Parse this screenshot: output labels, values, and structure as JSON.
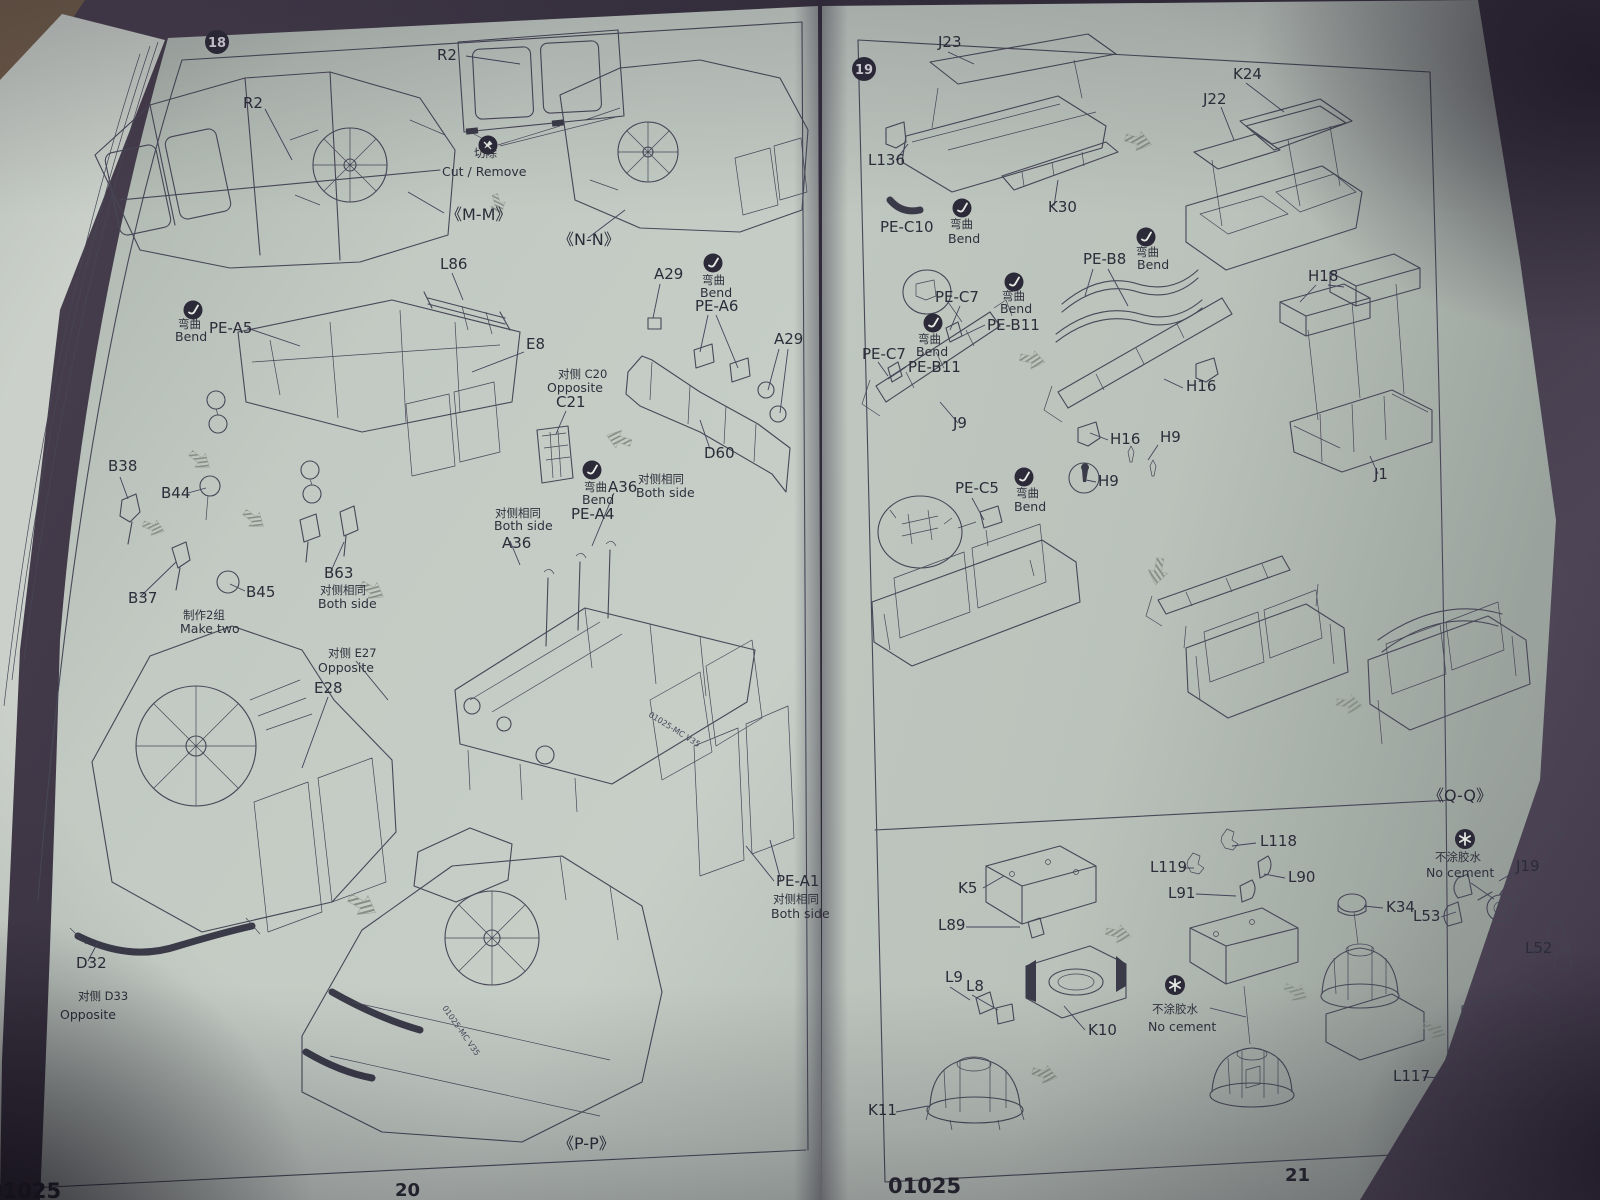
{
  "kit_number": "01025",
  "colors": {
    "paper": "#bcc4bd",
    "ink": "#474757",
    "background": "#3a3342",
    "badge": "#2c2a38"
  },
  "icons": {
    "bend": "dark-circle-with-white-bent-wire",
    "cut_remove": "dark-circle-with-white-blade",
    "no_cement": "dark-circle-with-white-asterisk",
    "step_badge": "dark-filled-circle-white-number"
  },
  "left_page": {
    "step": "18",
    "page_number": "20",
    "kit_code": "01025",
    "labels": [
      {
        "text": "R2"
      },
      {
        "text": "R2"
      },
      {
        "text": "切除"
      },
      {
        "text": "Cut / Remove"
      },
      {
        "text": "《M-M》"
      },
      {
        "text": "《N-N》"
      },
      {
        "text": "L86"
      },
      {
        "text": "弯曲"
      },
      {
        "text": "Bend"
      },
      {
        "text": "PE-A5"
      },
      {
        "text": "E8"
      },
      {
        "text": "对侧 C20"
      },
      {
        "text": "Opposite"
      },
      {
        "text": "C21"
      },
      {
        "text": "A29"
      },
      {
        "text": "弯曲"
      },
      {
        "text": "Bend"
      },
      {
        "text": "PE-A6"
      },
      {
        "text": "A29"
      },
      {
        "text": "D60"
      },
      {
        "text": "B38"
      },
      {
        "text": "B44"
      },
      {
        "text": "B37"
      },
      {
        "text": "B45"
      },
      {
        "text": "制作2组"
      },
      {
        "text": "Make two"
      },
      {
        "text": "B63"
      },
      {
        "text": "对侧相同"
      },
      {
        "text": "Both side"
      },
      {
        "text": "弯曲"
      },
      {
        "text": "Bend"
      },
      {
        "text": "PE-A4"
      },
      {
        "text": "A36"
      },
      {
        "text": "对侧相同"
      },
      {
        "text": "Both side"
      },
      {
        "text": "对侧相同"
      },
      {
        "text": "Both side"
      },
      {
        "text": "A36"
      },
      {
        "text": "对侧 E27"
      },
      {
        "text": "Opposite"
      },
      {
        "text": "E28"
      },
      {
        "text": "D32"
      },
      {
        "text": "对侧 D33"
      },
      {
        "text": "Opposite"
      },
      {
        "text": "PE-A1"
      },
      {
        "text": "对侧相同"
      },
      {
        "text": "Both side"
      },
      {
        "text": "《P-P》"
      },
      {
        "text": "20"
      },
      {
        "text": "01025"
      },
      {
        "text": "01025-MC V35"
      },
      {
        "text": "01025-MC V35"
      }
    ]
  },
  "right_page": {
    "step": "19",
    "page_number": "21",
    "kit_code": "01025",
    "labels": [
      {
        "text": "J23"
      },
      {
        "text": "L136"
      },
      {
        "text": "PE-C10"
      },
      {
        "text": "弯曲"
      },
      {
        "text": "Bend"
      },
      {
        "text": "K30"
      },
      {
        "text": "K24"
      },
      {
        "text": "J22"
      },
      {
        "text": "PE-C7"
      },
      {
        "text": "弯曲"
      },
      {
        "text": "Bend"
      },
      {
        "text": "PE-B11"
      },
      {
        "text": "PE-C7"
      },
      {
        "text": "弯曲"
      },
      {
        "text": "Bend"
      },
      {
        "text": "PE-B11"
      },
      {
        "text": "J9"
      },
      {
        "text": "PE-B8"
      },
      {
        "text": "弯曲"
      },
      {
        "text": "Bend"
      },
      {
        "text": "H16"
      },
      {
        "text": "H16"
      },
      {
        "text": "H9"
      },
      {
        "text": "H9"
      },
      {
        "text": "PE-C5"
      },
      {
        "text": "弯曲"
      },
      {
        "text": "Bend"
      },
      {
        "text": "H18"
      },
      {
        "text": "J1"
      },
      {
        "text": "《Q-Q》"
      },
      {
        "text": "K5"
      },
      {
        "text": "L89"
      },
      {
        "text": "L9"
      },
      {
        "text": "L8"
      },
      {
        "text": "K10"
      },
      {
        "text": "K11"
      },
      {
        "text": "L119"
      },
      {
        "text": "L118"
      },
      {
        "text": "L91"
      },
      {
        "text": "L90"
      },
      {
        "text": "不涂胶水"
      },
      {
        "text": "No cement"
      },
      {
        "text": "K34"
      },
      {
        "text": "L53"
      },
      {
        "text": "不涂胶水"
      },
      {
        "text": "No cement"
      },
      {
        "text": "J19"
      },
      {
        "text": "L52"
      },
      {
        "text": "L117"
      },
      {
        "text": "01025"
      },
      {
        "text": "21"
      }
    ]
  }
}
